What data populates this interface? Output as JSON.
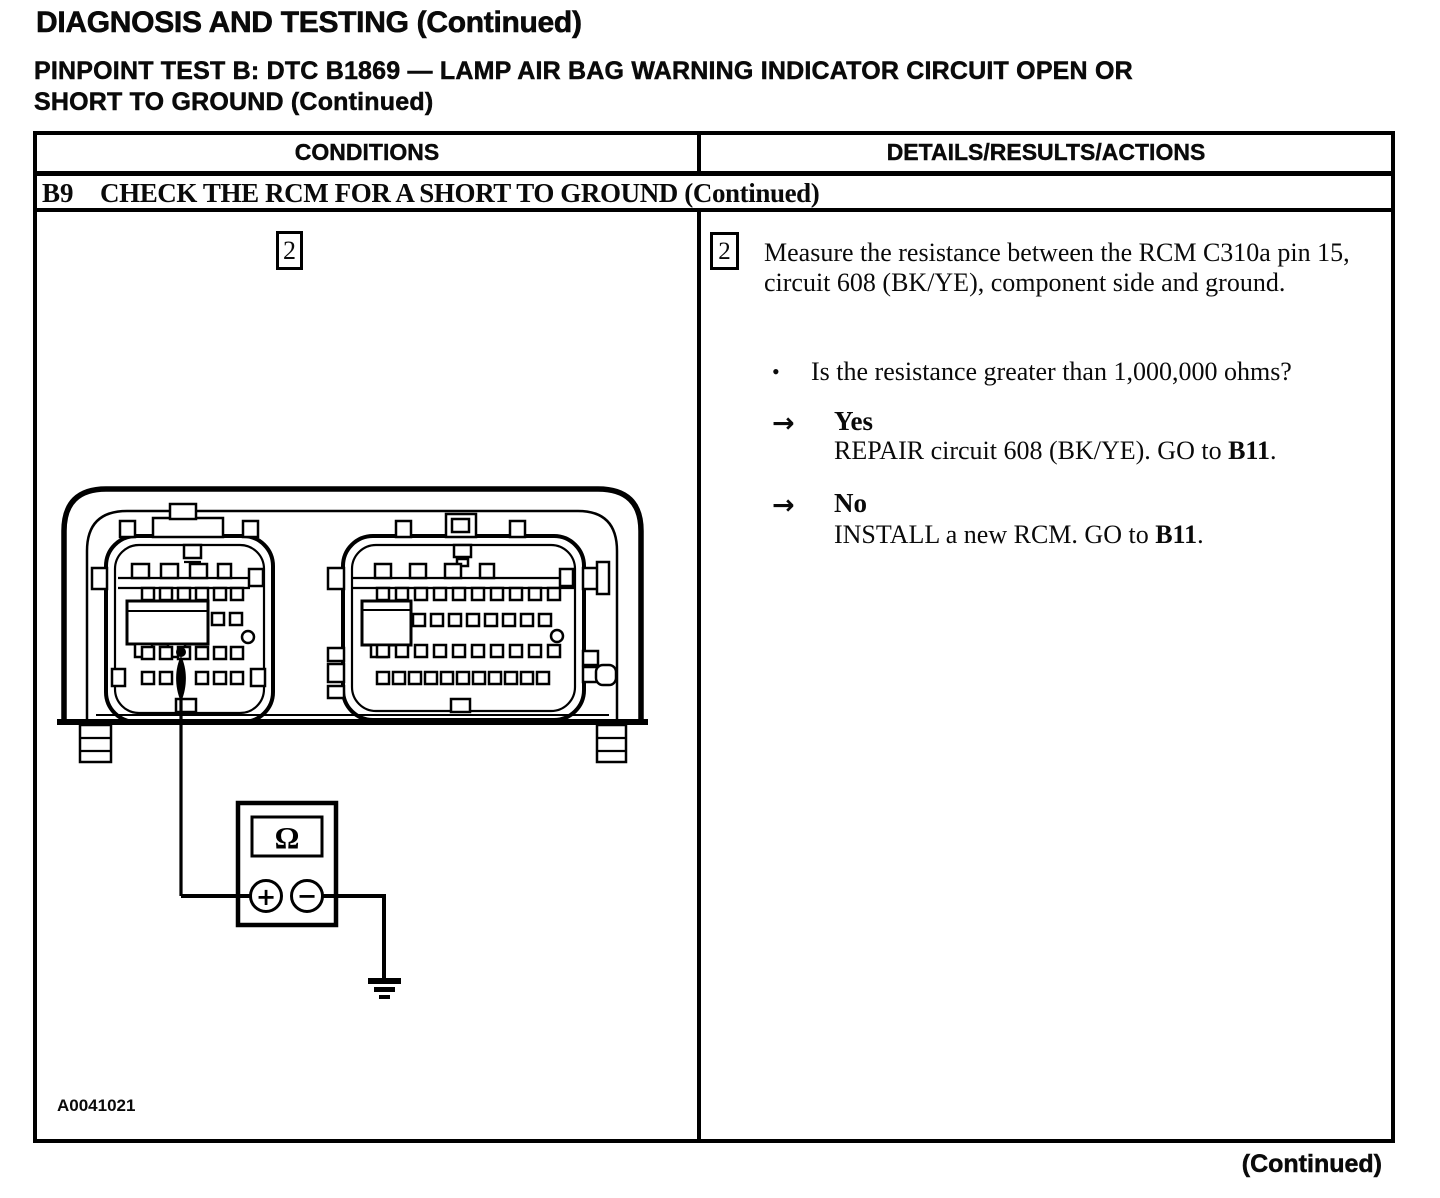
{
  "page": {
    "title": "DIAGNOSIS AND TESTING (Continued)",
    "subtitle_line1": "PINPOINT TEST B: DTC B1869 — LAMP AIR BAG WARNING INDICATOR CIRCUIT OPEN OR",
    "subtitle_line2": "SHORT TO GROUND (Continued)",
    "footer_continued": "(Continued)"
  },
  "glyphs": {
    "bullet": "•",
    "arrow": "→"
  },
  "table": {
    "headers": [
      "CONDITIONS",
      "DETAILS/RESULTS/ACTIONS"
    ],
    "step_row": {
      "id": "B9",
      "title": "CHECK THE RCM FOR A SHORT TO GROUND (Continued)"
    },
    "conditions": {
      "figure_step_number": "2",
      "figure_id": "A0041021",
      "meter": {
        "display_symbol": "Ω",
        "positive_symbol": "+",
        "negative_symbol": "−"
      }
    },
    "details": {
      "step_number": "2",
      "instruction": "Measure the resistance between the RCM C310a pin 15, circuit 608 (BK/YE), component side and ground.",
      "question": "Is the resistance greater than 1,000,000 ohms?",
      "outcomes": [
        {
          "label": "Yes",
          "action_prefix": "REPAIR circuit 608 (BK/YE). GO to ",
          "action_target": "B11",
          "action_suffix": "."
        },
        {
          "label": "No",
          "action_prefix": "INSTALL a new RCM. GO to ",
          "action_target": "B11",
          "action_suffix": "."
        }
      ]
    }
  }
}
